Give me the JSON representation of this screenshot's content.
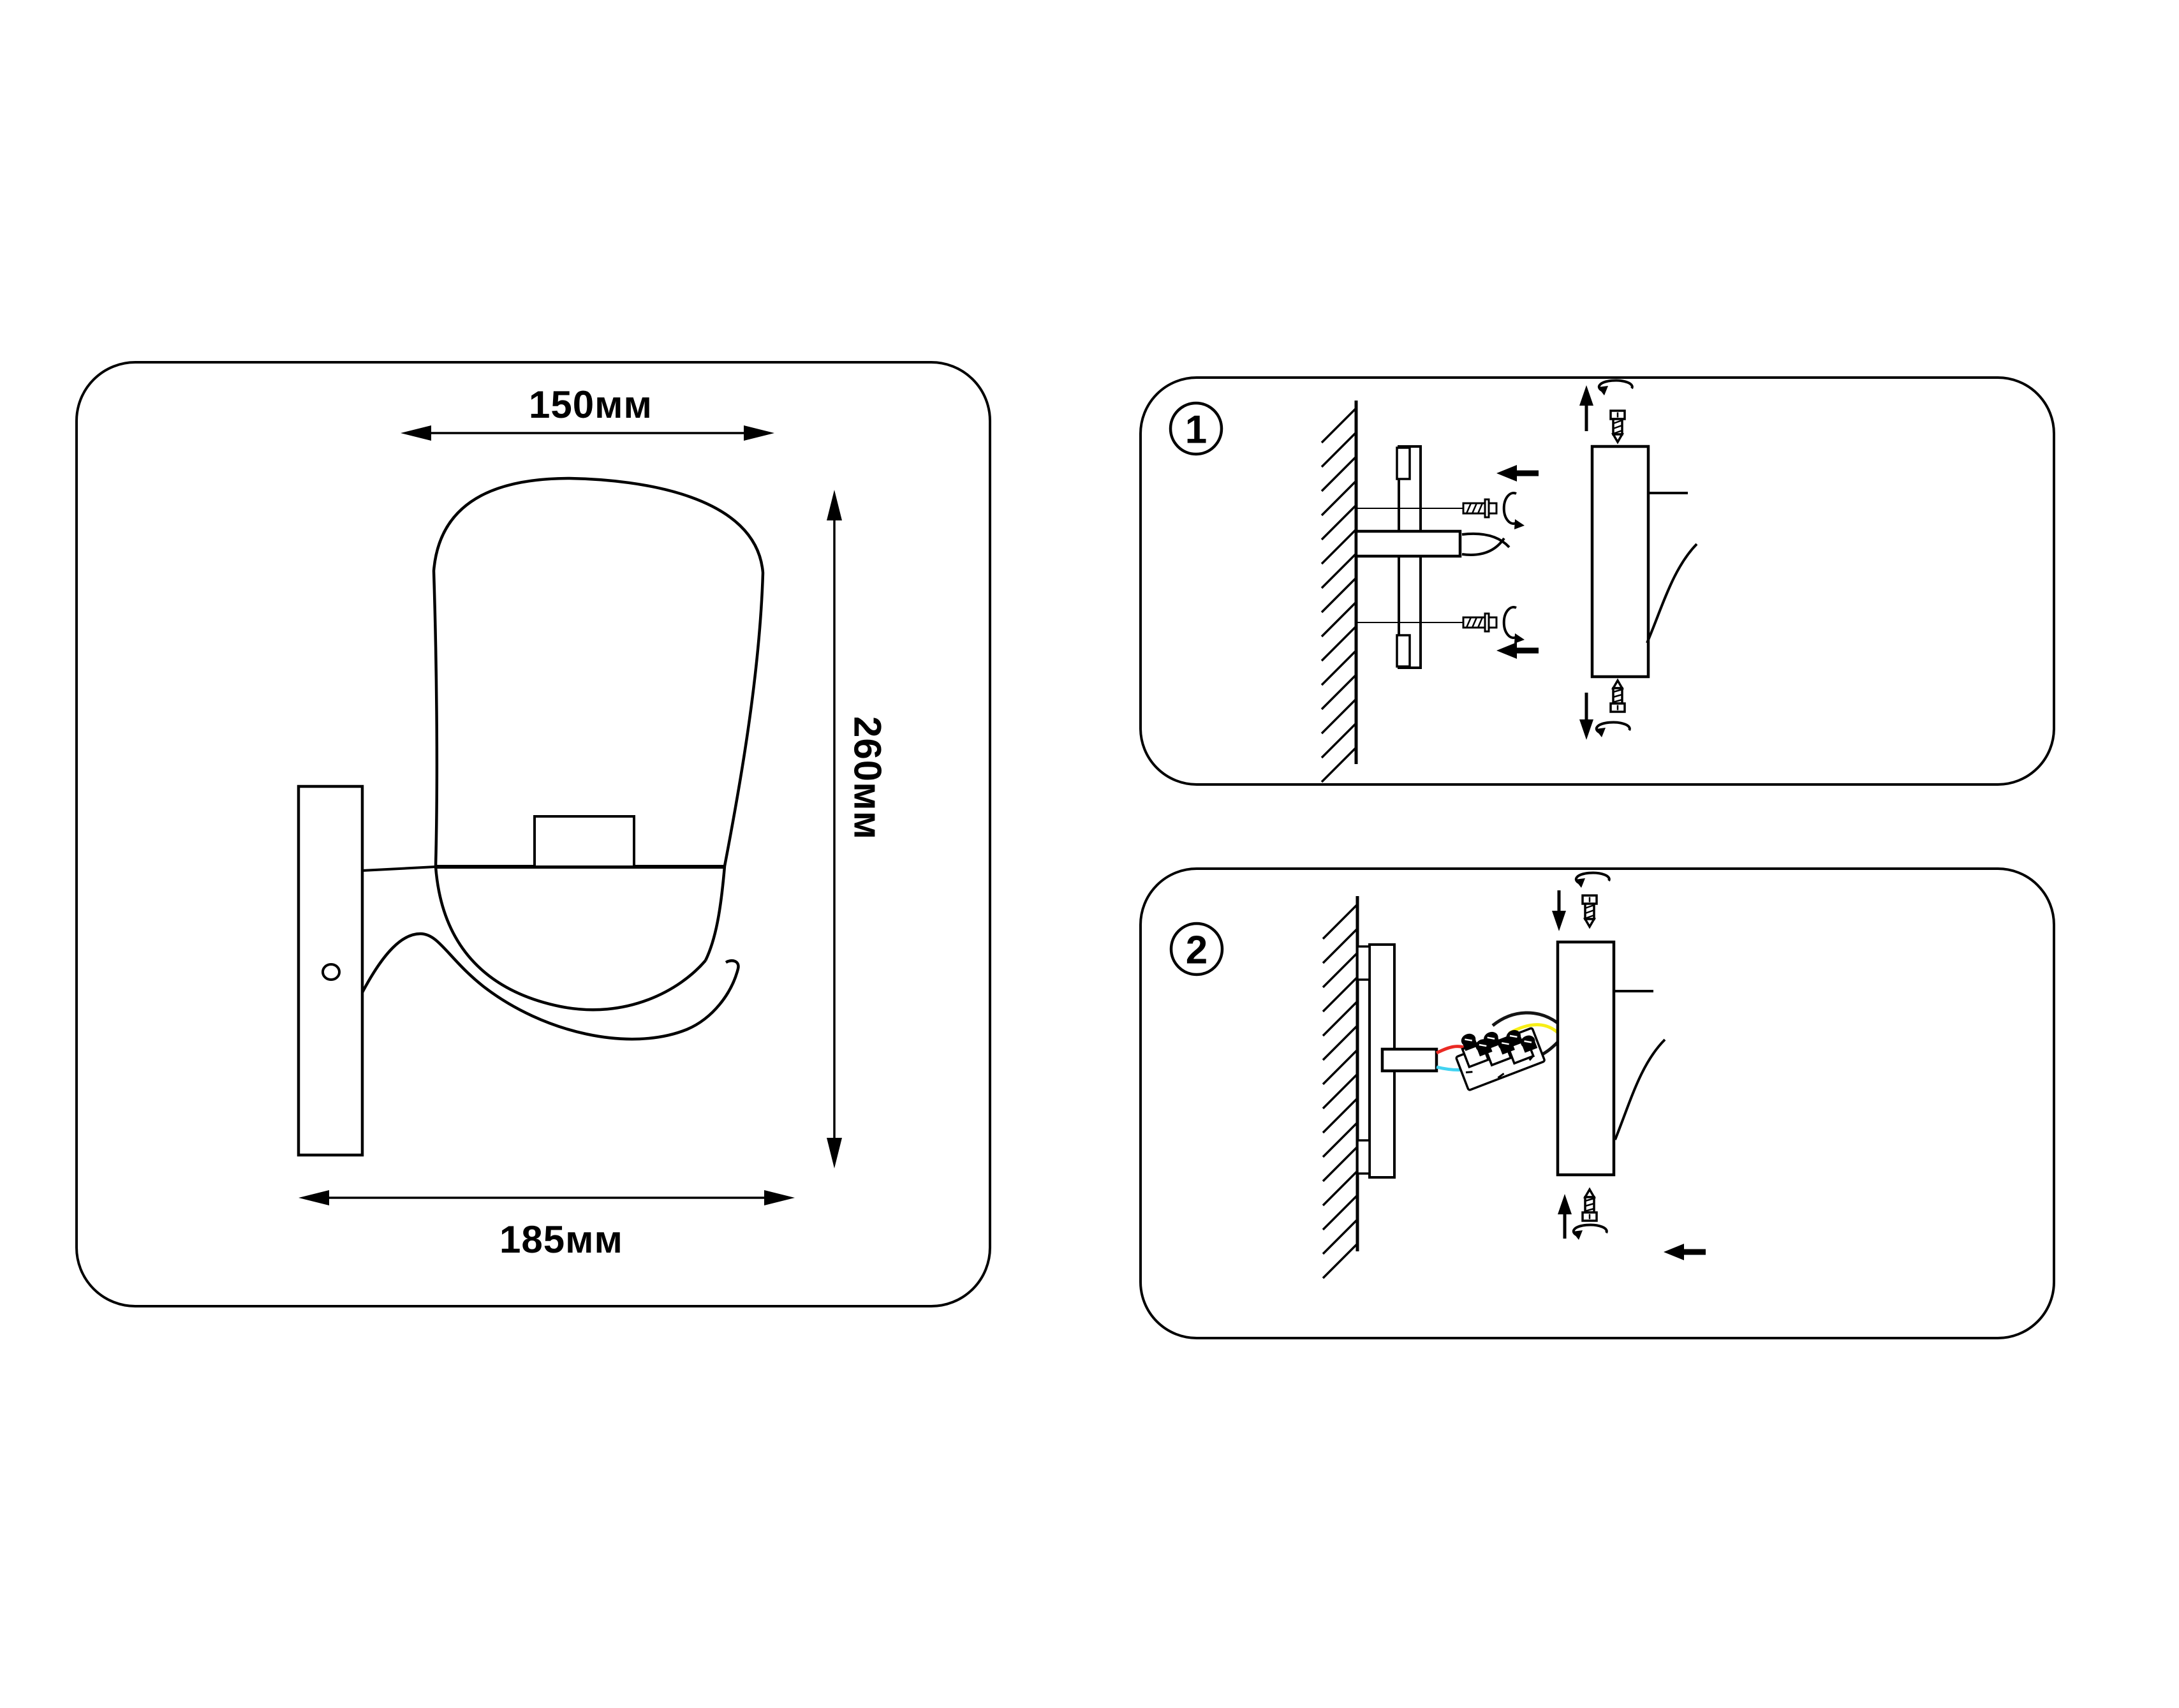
{
  "panels": {
    "dimensions": {
      "width_label": "150мм",
      "height_label": "260мм",
      "depth_label": "185мм"
    },
    "step1": {
      "badge": "1"
    },
    "step2": {
      "badge": "2"
    }
  },
  "colors": {
    "line": "#000000",
    "background": "#ffffff",
    "wire_red": "#ea2a24",
    "wire_yellow": "#f7ee17",
    "wire_cyan": "#43d3f1",
    "wire_black": "#141414"
  },
  "icons": {
    "rotation": "rotate-arrow-icon",
    "screw": "screw-icon",
    "arrow_left": "arrow-left-icon",
    "arrow_up": "arrow-up-icon",
    "arrow_down": "arrow-down-icon"
  }
}
